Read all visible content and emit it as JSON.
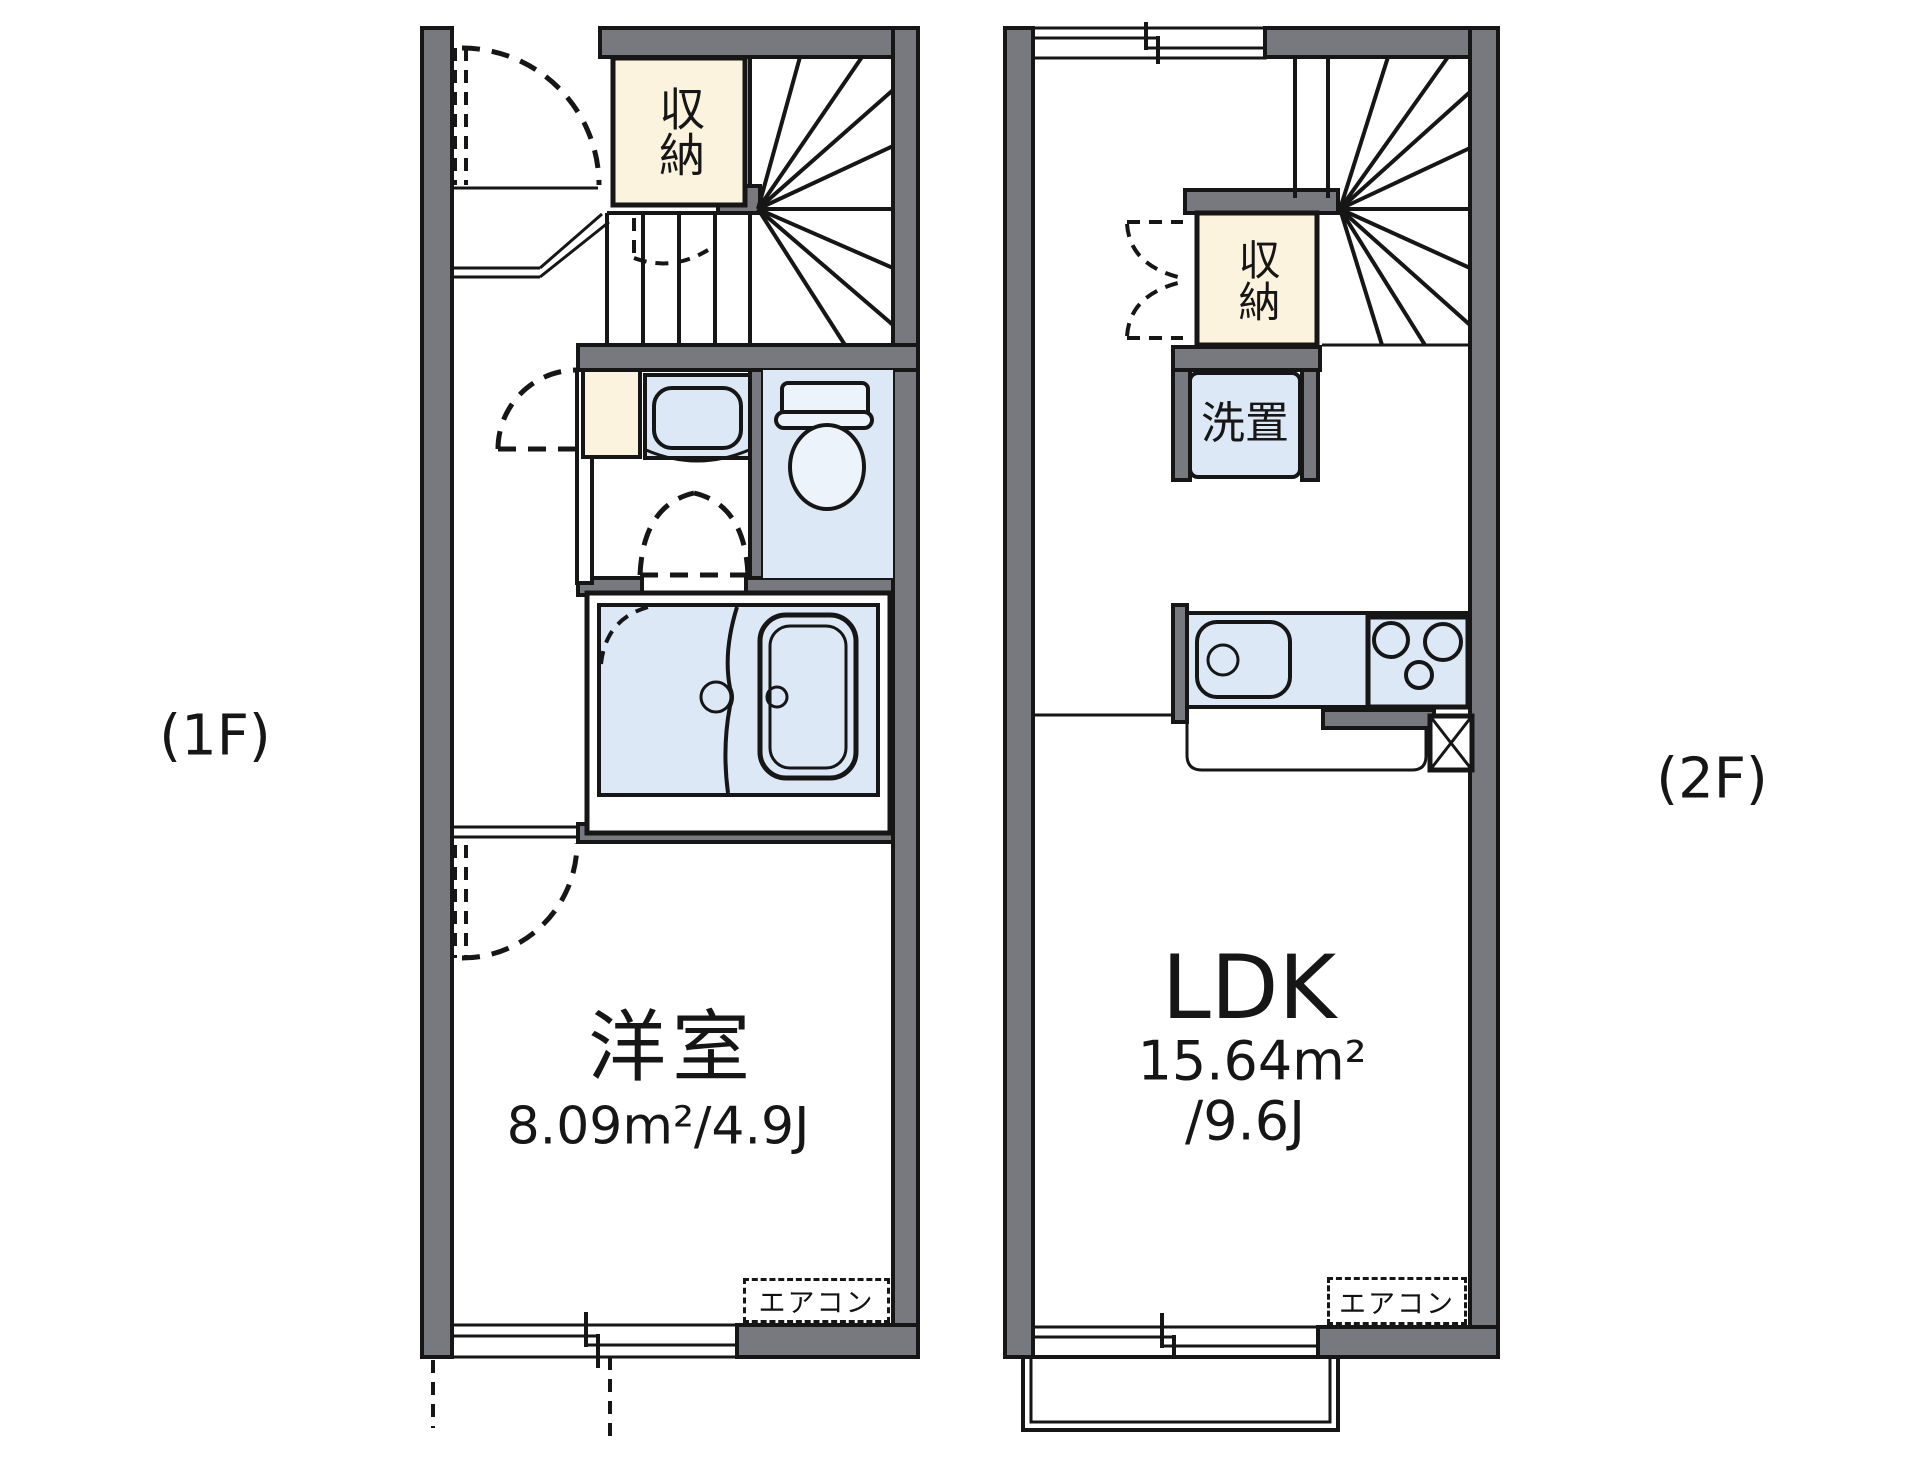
{
  "colors": {
    "wall": "#78787f",
    "closet": "#fcf3de",
    "wet": "#dde8f7",
    "line": "#161616"
  },
  "floor1": {
    "label": "(1F)",
    "closet": "収納",
    "room_name": "洋室",
    "room_area": "8.09m²/4.9J",
    "aircon": "エアコン"
  },
  "floor2": {
    "label": "(2F)",
    "closet": "収納",
    "laundry": "洗置",
    "room_name": "LDK",
    "room_area_m2": "15.64m²",
    "room_area_j": "/9.6J",
    "aircon": "エアコン"
  }
}
